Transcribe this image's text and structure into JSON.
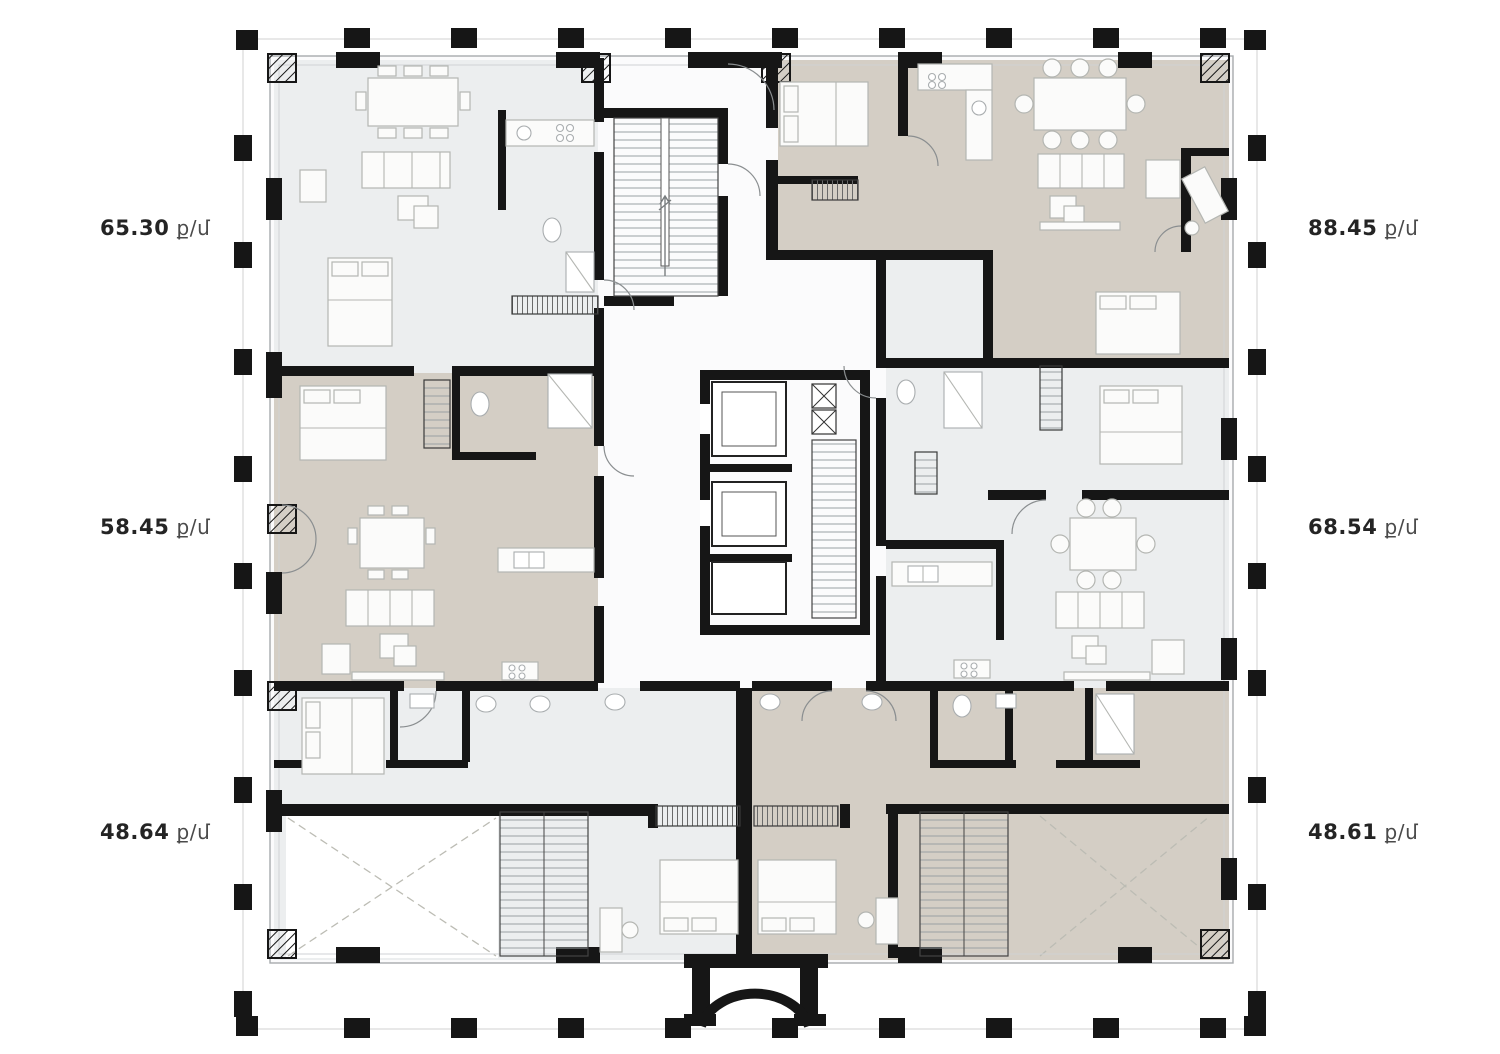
{
  "plan": {
    "name": "residential-floor-plan",
    "unit_label": "ք/մ",
    "apartments": [
      {
        "id": "top-left",
        "area": "65.30",
        "fill": "light"
      },
      {
        "id": "middle-left",
        "area": "58.45",
        "fill": "taupe"
      },
      {
        "id": "bottom-left",
        "area": "48.64",
        "fill": "light"
      },
      {
        "id": "top-right",
        "area": "88.45",
        "fill": "taupe"
      },
      {
        "id": "middle-right",
        "area": "68.54",
        "fill": "light"
      },
      {
        "id": "bottom-right",
        "area": "48.61",
        "fill": "taupe"
      }
    ],
    "colors": {
      "wall": "#161616",
      "apartment_light": "#ECEEEF",
      "apartment_taupe": "#D4CEC5",
      "outline": "#A7ABAD",
      "furniture_stroke": "#B4B6B2",
      "label_number": "#242424",
      "label_unit": "#4A4A4A",
      "background": "#FFFFFF"
    }
  }
}
